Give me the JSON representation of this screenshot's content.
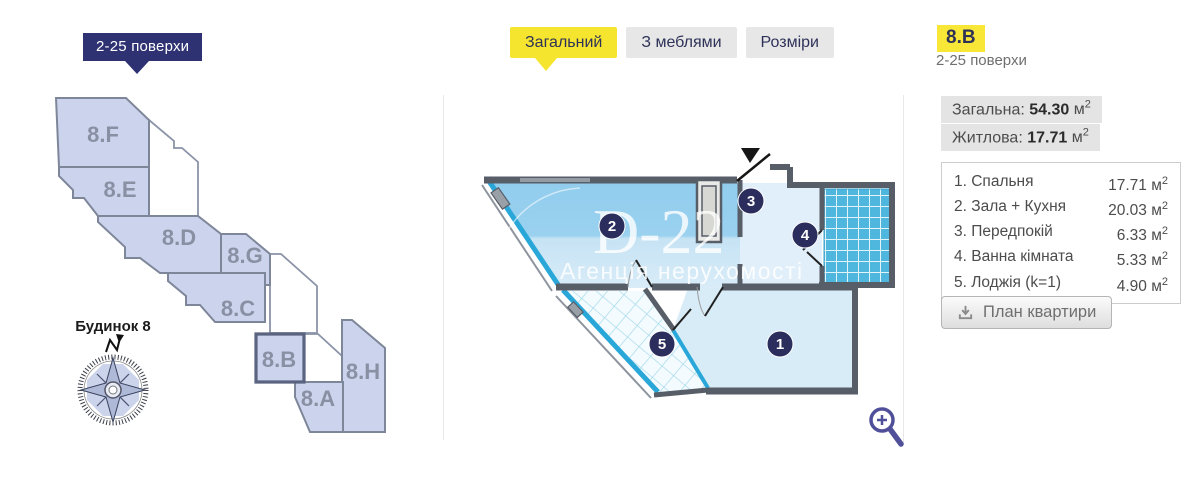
{
  "left_panel": {
    "floors_badge": "2-25 поверхи",
    "building_label": "Будинок 8",
    "compass_icon": "compass-rose-icon",
    "north_arrow_icon": "north-arrow-icon",
    "sections": [
      {
        "label": "8.F",
        "selected": false
      },
      {
        "label": "8.E",
        "selected": false
      },
      {
        "label": "8.D",
        "selected": false
      },
      {
        "label": "8.G",
        "selected": false
      },
      {
        "label": "8.C",
        "selected": false
      },
      {
        "label": "8.B",
        "selected": true
      },
      {
        "label": "8.H",
        "selected": false
      },
      {
        "label": "8.A",
        "selected": false
      }
    ]
  },
  "tabs": [
    {
      "label": "Загальний",
      "active": true
    },
    {
      "label": "З меблями",
      "active": false
    },
    {
      "label": "Розміри",
      "active": false
    }
  ],
  "floor_plan": {
    "watermark_title": "D-22",
    "watermark_subtitle": "Агенція нерухомості",
    "room_markers": [
      "1",
      "2",
      "3",
      "4",
      "5"
    ],
    "entrance_icon": "entrance-arrow-icon",
    "zoom_icon": "magnifier-plus-icon"
  },
  "right_panel": {
    "apartment_code": "8.B",
    "floors": "2-25 поверхи",
    "unit": "м",
    "unit_sup": "2",
    "total_area": {
      "label": "Загальна:",
      "value": "54.30"
    },
    "living_area": {
      "label": "Житлова:",
      "value": "17.71"
    },
    "rooms": [
      {
        "num": "1.",
        "name": "Спальня",
        "area": "17.71"
      },
      {
        "num": "2.",
        "name": "Зала + Кухня",
        "area": "20.03"
      },
      {
        "num": "3.",
        "name": "Передпокій",
        "area": "6.33"
      },
      {
        "num": "4.",
        "name": "Ванна кімната",
        "area": "5.33"
      },
      {
        "num": "5.",
        "name": "Лоджія (k=1)",
        "area": "4.90"
      }
    ],
    "download_button": "План квартири",
    "download_icon": "download-tray-icon"
  },
  "colors": {
    "accent_yellow": "#f6e52e",
    "badge_navy": "#2e3172",
    "block_fill": "#ccd4ed",
    "block_border": "#8b93a8",
    "window_cyan": "#2aa7d9",
    "wall_gray": "#575e68",
    "tile_blue": "#4fb6dd",
    "marker_navy": "#2b2e5c",
    "room_fill_light": "#d8ecf8",
    "room_fill_strong": "#96cfee"
  }
}
